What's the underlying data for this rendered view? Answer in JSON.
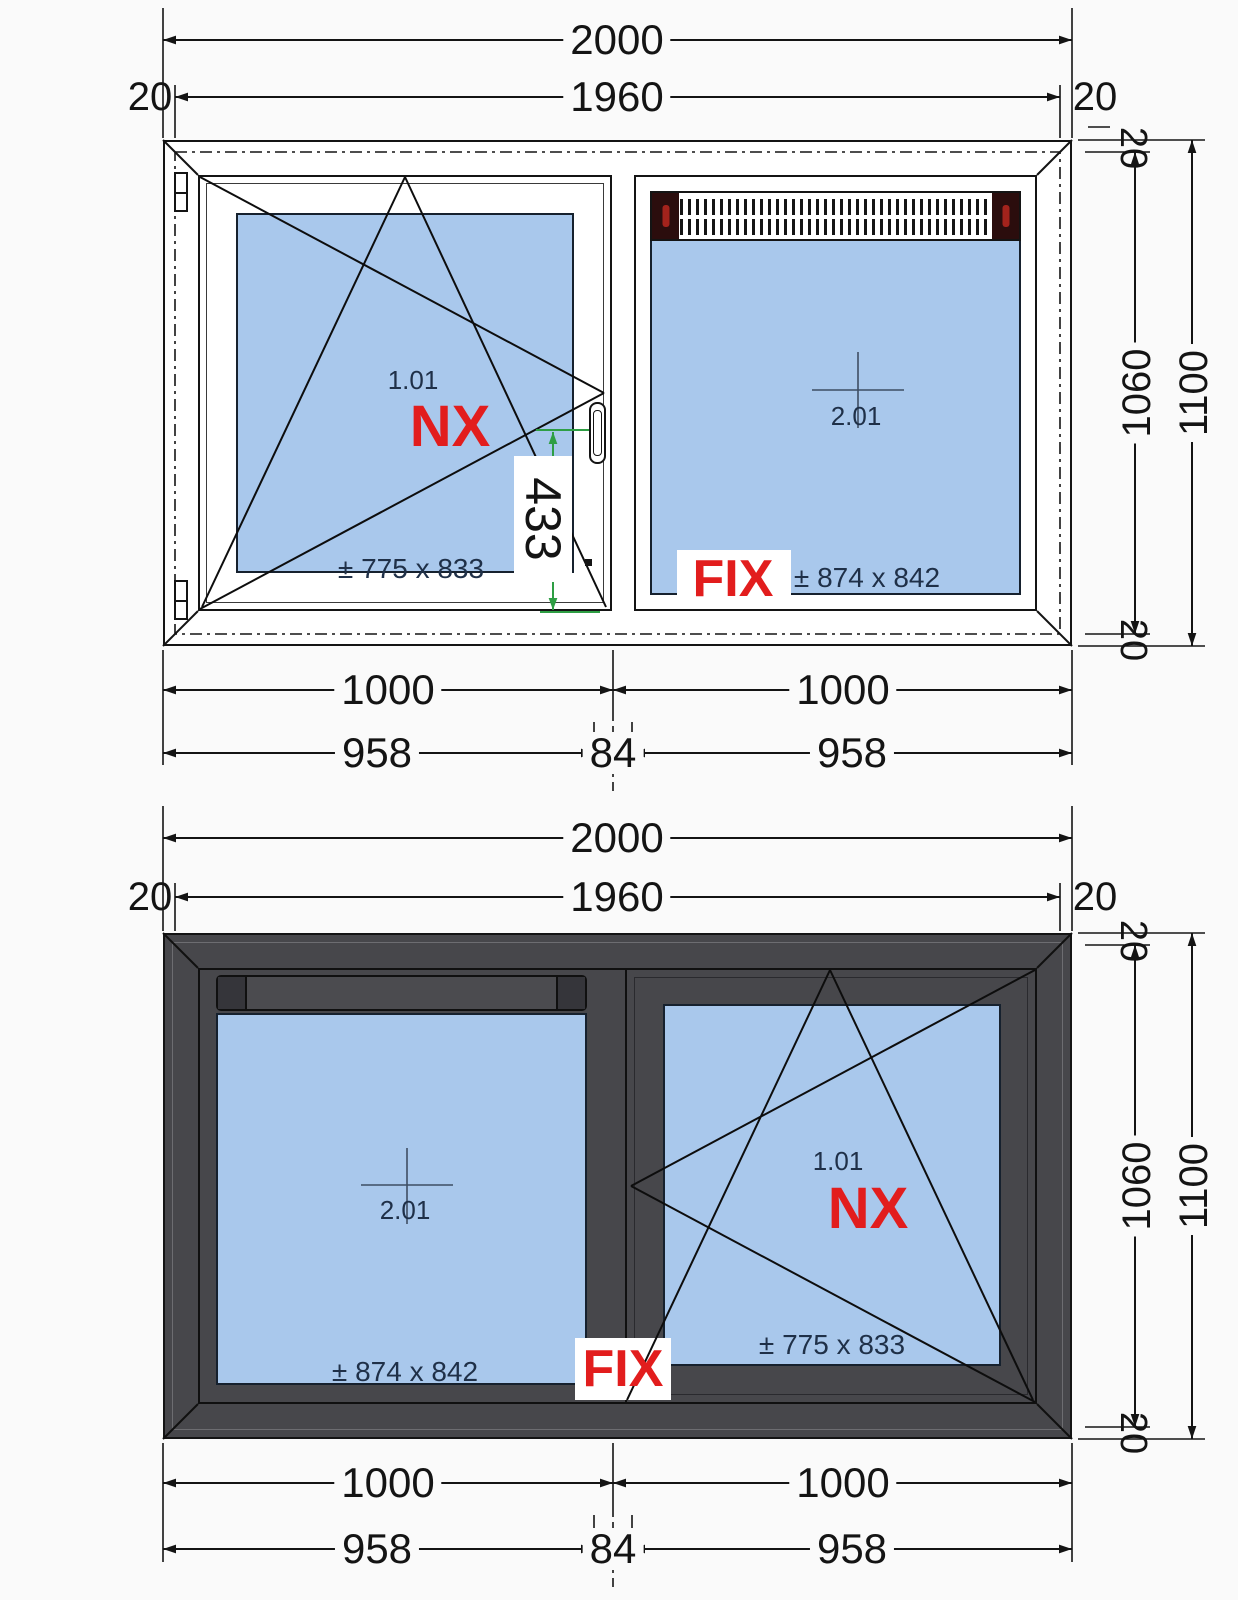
{
  "dims": {
    "total_width": "2000",
    "inner_width": "1960",
    "edge": "20",
    "pane_width": "1000",
    "sash_width": "958",
    "mullion_width": "84",
    "inner_height": "1060",
    "total_height": "1100",
    "handle_height": "433"
  },
  "panes": {
    "turn_tilt": {
      "id": "1.01",
      "system": "NX",
      "size": "± 775 x 833"
    },
    "fixed": {
      "id": "2.01",
      "label": "FIX",
      "size": "± 874 x 842"
    }
  },
  "colors": {
    "glass": "#a9c8ec",
    "frame_dark": "#47474b",
    "frame_white": "#ffffff",
    "label_red": "#e21d1d",
    "dim_green": "#2e9e44",
    "line": "#141414",
    "grille_cap": "#2b0d0d"
  }
}
